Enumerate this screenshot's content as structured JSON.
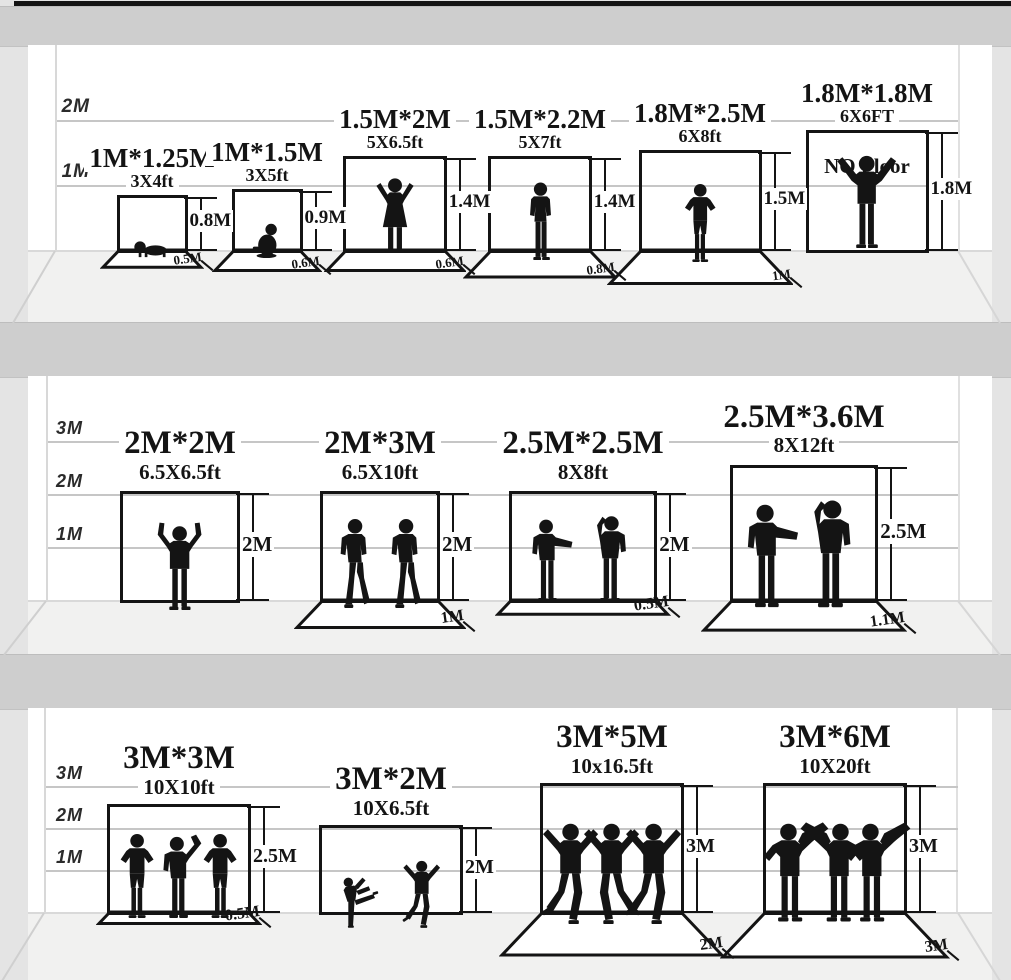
{
  "poster": {
    "description": "Photography backdrop size comparison chart",
    "colors": {
      "ink": "#141414",
      "wall": "#ffffff",
      "floor_strip": "#f1f1f0",
      "shelf_band": "#cecece",
      "background": "#e4e4e4",
      "gridline": "#c6c6c6"
    }
  },
  "rows": [
    {
      "scale_labels": [
        "2M",
        "1M"
      ],
      "items": [
        {
          "name": "1M*1.25M",
          "size_ft": "3X4ft",
          "height_label": "0.8M",
          "floor_label": "0.5M",
          "note": null,
          "figures": [
            "baby-crawling"
          ]
        },
        {
          "name": "1M*1.5M",
          "size_ft": "3X5ft",
          "height_label": "0.9M",
          "floor_label": "0.6M",
          "note": null,
          "figures": [
            "toddler-sitting"
          ]
        },
        {
          "name": "1.5M*2M",
          "size_ft": "5X6.5ft",
          "height_label": "1.4M",
          "floor_label": "0.6M",
          "note": null,
          "figures": [
            "child-arms-up"
          ]
        },
        {
          "name": "1.5M*2.2M",
          "size_ft": "5X7ft",
          "height_label": "1.4M",
          "floor_label": "0.8M",
          "note": null,
          "figures": [
            "boy-standing"
          ]
        },
        {
          "name": "1.8M*2.5M",
          "size_ft": "6X8ft",
          "height_label": "1.5M",
          "floor_label": "1M",
          "note": null,
          "figures": [
            "man-hands-hips"
          ]
        },
        {
          "name": "1.8M*1.8M",
          "size_ft": "6X6FT",
          "height_label": "1.8M",
          "floor_label": null,
          "note": "NO Floor",
          "figures": [
            "man-arms-raised"
          ]
        }
      ]
    },
    {
      "scale_labels": [
        "3M",
        "2M",
        "1M"
      ],
      "items": [
        {
          "name": "2M*2M",
          "size_ft": "6.5X6.5ft",
          "height_label": "2M",
          "floor_label": null,
          "note": null,
          "figures": [
            "man-victory"
          ]
        },
        {
          "name": "2M*3M",
          "size_ft": "6.5X10ft",
          "height_label": "2M",
          "floor_label": "1M",
          "note": null,
          "figures": [
            "man-walking",
            "man-walking"
          ]
        },
        {
          "name": "2.5M*2.5M",
          "size_ft": "8X8ft",
          "height_label": "2M",
          "floor_label": "0.5M",
          "note": null,
          "figures": [
            "man-gesturing",
            "man-listening"
          ]
        },
        {
          "name": "2.5M*3.6M",
          "size_ft": "8X12ft",
          "height_label": "2.5M",
          "floor_label": "1.1M",
          "note": null,
          "figures": [
            "man-presenting",
            "man-on-phone"
          ]
        }
      ]
    },
    {
      "scale_labels": [
        "3M",
        "2M",
        "1M"
      ],
      "items": [
        {
          "name": "3M*3M",
          "size_ft": "10X10ft",
          "height_label": "2.5M",
          "floor_label": "0.5M",
          "note": null,
          "figures": [
            "person-hands-hips",
            "person-waving",
            "person-hands-hips-flip"
          ]
        },
        {
          "name": "3M*2M",
          "size_ft": "10X6.5ft",
          "height_label": "2M",
          "floor_label": null,
          "note": null,
          "figures": [
            "dancer-kick",
            "dancer"
          ]
        },
        {
          "name": "3M*5M",
          "size_ft": "10x16.5ft",
          "height_label": "3M",
          "floor_label": "2M",
          "note": null,
          "figures": [
            "dancer",
            "dancer-flip",
            "dancer"
          ]
        },
        {
          "name": "3M*6M",
          "size_ft": "10X20ft",
          "height_label": "3M",
          "floor_label": "3M",
          "note": null,
          "figures": [
            "musician",
            "musician-flip",
            "musician"
          ]
        }
      ]
    }
  ]
}
